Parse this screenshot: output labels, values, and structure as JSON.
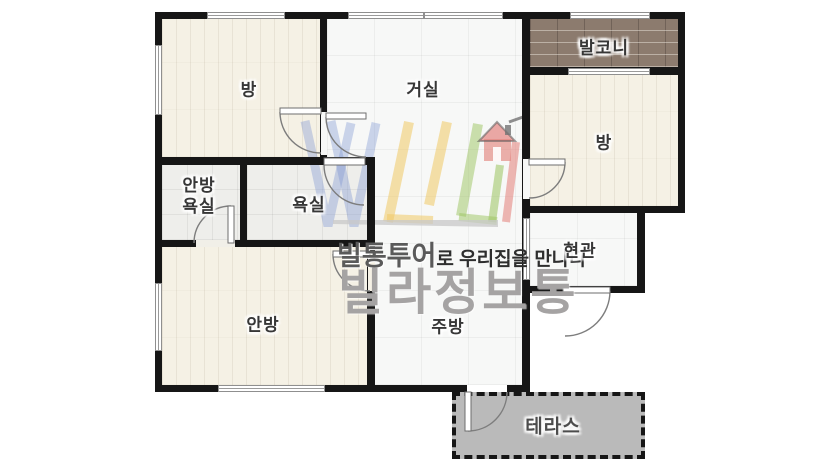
{
  "rooms": {
    "bedroom_top_left": "방",
    "living_room": "거실",
    "balcony": "발코니",
    "bedroom_right": "방",
    "master_bathroom_line1": "안방",
    "master_bathroom_line2": "욕실",
    "bathroom": "욕실",
    "entrance": "현관",
    "master_bedroom": "안방",
    "kitchen": "주방",
    "terrace": "테라스"
  },
  "watermark": {
    "tagline_bold": "빌통투어",
    "tagline_rest": "로 우리집을 만나다",
    "brand": "빌라정보통"
  },
  "colors": {
    "wall": "#161616",
    "wood_floor": "#f5f1e5",
    "tile_floor": "#f7f8f7",
    "bath_floor": "#eeeeeb",
    "balcony_brick": "#8c7b6e",
    "terrace_gray": "#bababa",
    "label_text": "#373737",
    "brand_gray": "#a5a3a3",
    "logo_blue": "#7d96d2",
    "logo_yellow": "#f0c864",
    "logo_green": "#9bc35f",
    "logo_red": "#e47d78"
  }
}
